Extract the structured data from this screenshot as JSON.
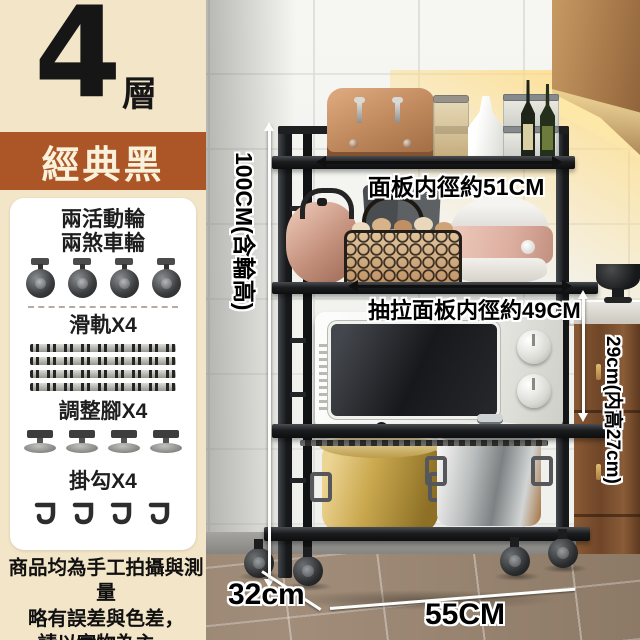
{
  "sidebar": {
    "tier_number": "4",
    "tier_unit": "層",
    "color_name": "經典黑",
    "accessories": {
      "wheels_line1": "兩活動輪",
      "wheels_line2": "兩煞車輪",
      "rails_label": "滑軌X4",
      "feet_label": "調整腳X4",
      "hooks_label": "掛勾X4"
    },
    "disclaimer_line1": "商品均為手工拍攝與測量",
    "disclaimer_line2": "略有誤差與色差，",
    "disclaimer_line3": "請以實物為主。"
  },
  "photo": {
    "annotations": {
      "top_shelf_width": "面板内徑約51CM",
      "pullout_shelf_width": "抽拉面板内徑約49CM",
      "total_height": "100CM(含輪高)",
      "compartment_height": "29cm(内高27cm)",
      "depth": "32cm",
      "base_width": "55CM"
    }
  },
  "colors": {
    "sidebar_bg": "#f3e5c8",
    "accent_band": "#ac5526",
    "band_text": "#f9f1da",
    "rack_black": "#1b1d1f",
    "annotation_text": "#000000",
    "annotation_outline": "#ffffff"
  }
}
